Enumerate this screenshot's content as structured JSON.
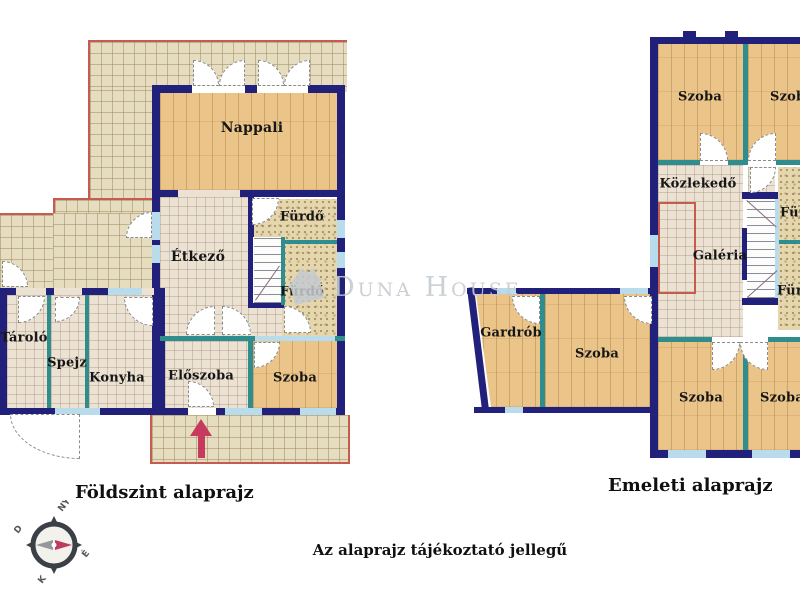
{
  "plans": {
    "ground": {
      "caption": "Földszint alaprajz",
      "rooms": {
        "nappali": "Nappali",
        "furdo_top": "Fürdő",
        "etkezo": "Étkező",
        "furdo_mid": "Fürdő",
        "tarolo": "Tároló",
        "spejz": "Spejz",
        "konyha": "Konyha",
        "eloszoba": "Előszoba",
        "szoba": "Szoba"
      }
    },
    "upper": {
      "caption": "Emeleti alaprajz",
      "rooms": {
        "szoba_tl": "Szoba",
        "szoba_tr": "Szoba",
        "kozlekedo": "Közlekedő",
        "furdo_top": "Fürdő",
        "galeria": "Galéria",
        "gardrob": "Gardrób",
        "szoba_mid": "Szoba",
        "szoba_bl": "Szoba",
        "szoba_br": "Szoba",
        "furdo_bottom": "Fürdő"
      }
    }
  },
  "watermark": {
    "text": "Duna House"
  },
  "footer": {
    "disclaimer": "Az alaprajz tájékoztató jellegű"
  },
  "compass": {
    "n": "É",
    "s": "D",
    "e": "K",
    "w": "NY"
  },
  "colors": {
    "wall": "#21217b",
    "partition": "#2f8d8d",
    "window": "#b9dcec",
    "outline": "#c65b4f",
    "arrow": "#c73a60",
    "wood": "#eac489",
    "tileout": "#e6ddc1",
    "tilein": "#ece2d4",
    "bath": "#e5d6ae",
    "wm": "#c6cbd1",
    "ink": "#161616"
  }
}
